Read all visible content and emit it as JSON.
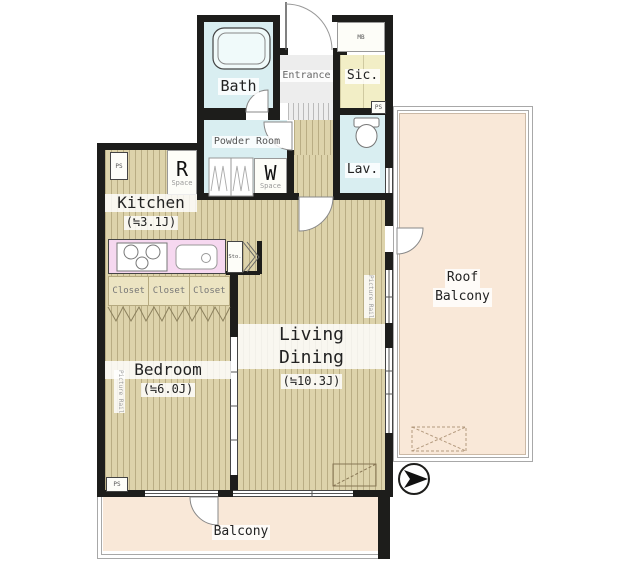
{
  "plan": {
    "title": "apartment-floor-plan",
    "rooms": {
      "bath": "Bath",
      "entrance": "Entrance",
      "sic": "Sic.",
      "powder_room": "Powder Room",
      "lav": "Lav.",
      "kitchen": "Kitchen",
      "kitchen_size": "(≒3.1J)",
      "living_line1": "Living",
      "living_line2": "Dining",
      "living_size": "(≒10.3J)",
      "bedroom": "Bedroom",
      "bedroom_size": "(≒6.0J)",
      "roof_balcony_line1": "Roof",
      "roof_balcony_line2": "Balcony",
      "balcony": "Balcony",
      "closets": [
        "Closet",
        "Closet",
        "Closet"
      ]
    },
    "features": {
      "r_space_letter": "R",
      "r_space_label": "Space",
      "w_space_letter": "W",
      "w_space_label": "Space",
      "ps": "PS",
      "mb": "MB",
      "sto": "Sto.",
      "picture_rail": "Picture Rail"
    },
    "colors": {
      "wall": "#1d1d1b",
      "wood_floor": "#ddd3ab",
      "wood_stripe": "#b9ad84",
      "wet_area": "#d9eef1",
      "sic_fill": "#f2eec6",
      "counter": "#f6d8f0",
      "balcony": "#f9e8d8",
      "closet_fill": "#ece4c2",
      "entrance_fill": "#ededed"
    }
  }
}
